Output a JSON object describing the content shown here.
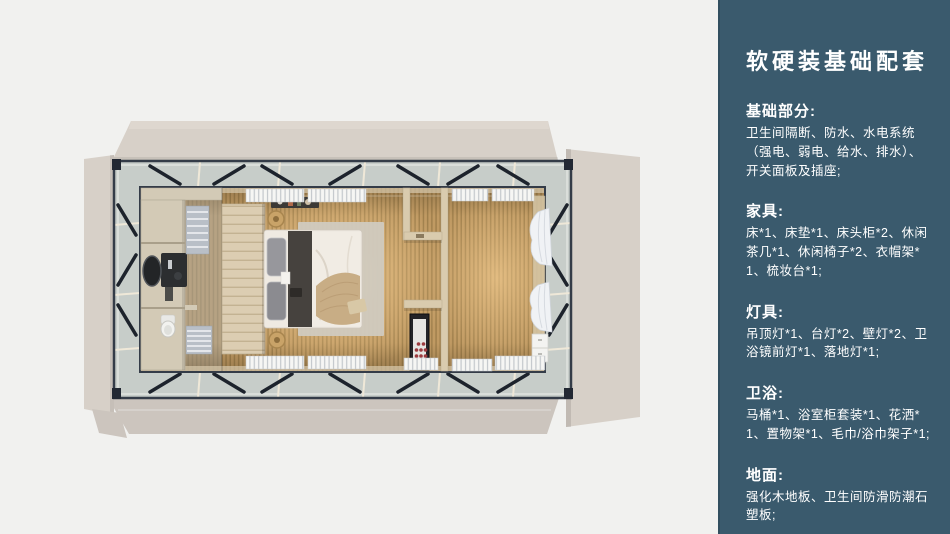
{
  "sidebar": {
    "title": "软硬装基础配套",
    "sections": [
      {
        "heading": "基础部分:",
        "body": "卫生间隔断、防水、水电系统（强电、弱电、给水、排水）、开关面板及插座;"
      },
      {
        "heading": "家具:",
        "body": "床*1、床垫*1、床头柜*2、休闲茶几*1、休闲椅子*2、衣帽架*1、梳妆台*1;"
      },
      {
        "heading": "灯具:",
        "body": "吊顶灯*1、台灯*2、壁灯*2、卫浴镜前灯*1、落地灯*1;"
      },
      {
        "heading": "卫浴:",
        "body": "马桶*1、浴室柜套装*1、花洒*1、置物架*1、毛巾/浴巾架子*1;"
      },
      {
        "heading": "地面:",
        "body": "强化木地板、卫生间防滑防潮石塑板;"
      }
    ]
  },
  "colors": {
    "sidebar_bg": "#3a5a6d",
    "sidebar_text": "#ffffff",
    "canvas_bg": "#f1f1ef",
    "flap": "#d7d0c8",
    "flap_dark": "#ccc5be",
    "frame_band": "#c7cdc9",
    "frame_line": "#343c48",
    "wood": "#c09a63",
    "wood_dark": "#9f7f4c",
    "glow": "#ffd89b",
    "bath_overlay": "#adaa9e",
    "cabinet": "#d3cab6",
    "wardrobe": "#dccdb2",
    "duvet": "#efeae2",
    "throw": "#c8ad85",
    "pillow": "#97979c",
    "rug": "#d0cabf",
    "curtain": "#f0f2f5",
    "cabinet_dark": "#232327",
    "accent_red": "#9c3a3e"
  }
}
